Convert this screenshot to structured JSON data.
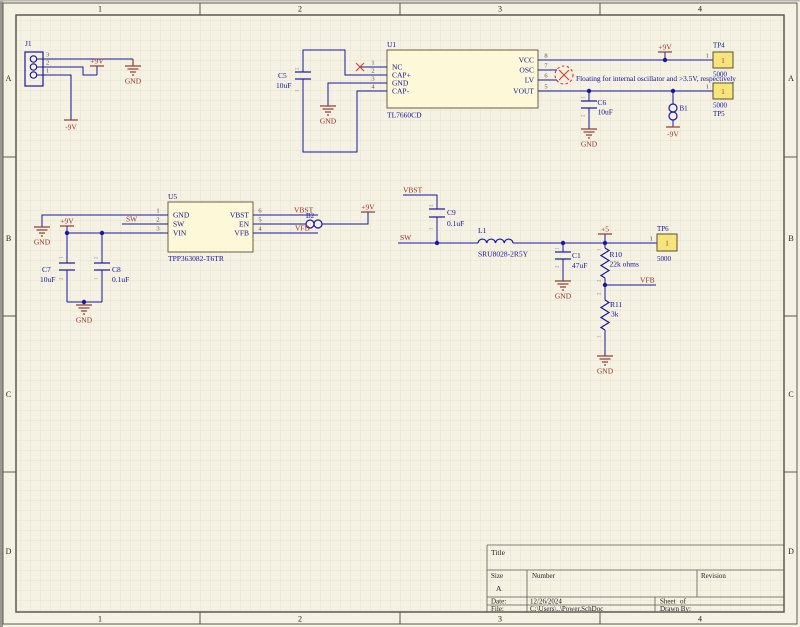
{
  "zones": {
    "c1": "1",
    "c2": "2",
    "c3": "3",
    "c4": "4",
    "ra": "A",
    "rb": "B",
    "rc": "C",
    "rd": "D"
  },
  "nets": {
    "p9v": "+9V",
    "n9v": "-9V",
    "p5": "+5",
    "gnd": "GND",
    "sw": "SW",
    "vbst": "VBST",
    "vfb": "VFB"
  },
  "note": {
    "floating": "Floating for internal oscillator and >3.5V, respectively"
  },
  "marks": {
    "m1": "1",
    "m2": "2"
  },
  "j1": {
    "ref": "J1",
    "p1": "1",
    "p2": "2",
    "p3": "3"
  },
  "u1": {
    "ref": "U1",
    "part": "TL7660CD",
    "pins": {
      "n1": "1",
      "n2": "2",
      "n3": "3",
      "n4": "4",
      "n5": "5",
      "n6": "6",
      "n7": "7",
      "n8": "8"
    },
    "names": {
      "nc": "NC",
      "capp": "CAP+",
      "gnd": "GND",
      "capm": "CAP-",
      "vcc": "VCC",
      "osc": "OSC",
      "lv": "LV",
      "vout": "VOUT"
    }
  },
  "u5": {
    "ref": "U5",
    "part": "TPP363082-T6TR",
    "pins": {
      "n1": "1",
      "n2": "2",
      "n3": "3",
      "n4": "4",
      "n5": "5",
      "n6": "6"
    },
    "names": {
      "gnd": "GND",
      "sw": "SW",
      "vin": "VIN",
      "vbst": "VBST",
      "en": "EN",
      "vfb": "VFB"
    }
  },
  "caps": {
    "c5": {
      "ref": "C5",
      "val": "10uF"
    },
    "c6": {
      "ref": "C6",
      "val": "10uF"
    },
    "c7": {
      "ref": "C7",
      "val": "10uF"
    },
    "c8": {
      "ref": "C8",
      "val": "0.1uF"
    },
    "c9": {
      "ref": "C9",
      "val": "0.1uF"
    },
    "c1": {
      "ref": "C1",
      "val": "47uF"
    }
  },
  "l1": {
    "ref": "L1",
    "val": "SRU8028-2R5Y"
  },
  "r10": {
    "ref": "R10",
    "val": "22k ohms"
  },
  "r11": {
    "ref": "R11",
    "val": "3k"
  },
  "b1": {
    "ref": "B1"
  },
  "b2": {
    "ref": "B2"
  },
  "tp": {
    "tp4": {
      "ref": "TP4",
      "pin": "1",
      "pad": "1",
      "val": "5000"
    },
    "tp5": {
      "ref": "TP5",
      "pin": "1",
      "pad": "1",
      "val": "5000"
    },
    "tp6": {
      "ref": "TP6",
      "pin": "1",
      "pad": "1",
      "val": "5000"
    }
  },
  "titleblock": {
    "title": "Title",
    "size": "Size",
    "size_val": "A",
    "number": "Number",
    "revision": "Revision",
    "date": "Date:",
    "date_val": "12/26/2024",
    "file": "File:",
    "file_val": "C:\\Users\\..\\Power.SchDoc",
    "sheet": "Sheet",
    "of": "of",
    "drawn": "Drawn By:"
  }
}
